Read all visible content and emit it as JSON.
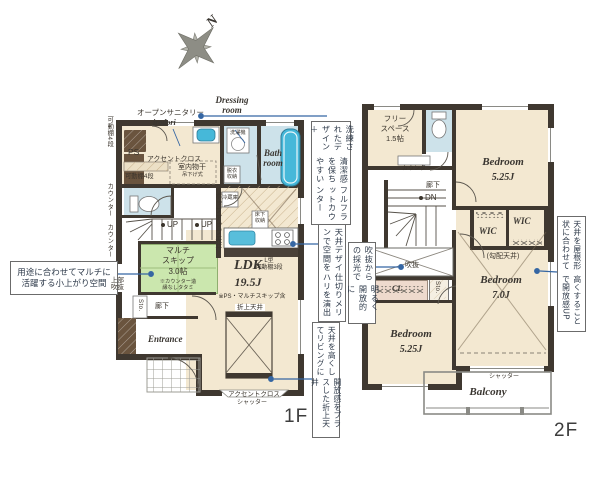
{
  "compass": {
    "north": "N"
  },
  "annotations": {
    "multi_skip": {
      "line1": "用途に合わせてマルチに",
      "line2": "活躍する小上がり空間"
    },
    "counter": {
      "col1": "洗練されたデザイン＋",
      "col2": "清潔感を保ちやすい",
      "col3": "フルフラットカウンター"
    },
    "ceiling_design": {
      "col1": "天井デザインで空間を",
      "col2": "仕切りメリハリを演出"
    },
    "folded_ceiling": {
      "col1": "天井を高くしてリビングに",
      "col2": "開放感をプラスした折上天井"
    },
    "void_light": {
      "col1": "吹抜からの採光で",
      "col2": "明るく開放的に"
    },
    "roof_ceiling": {
      "col1": "天井を屋根形状に合わせて",
      "col2": "高くすることで開放感UP"
    }
  },
  "floor1": {
    "floor_label": "1F",
    "open_sanitary": "オープンサニタリー",
    "irodori": "irodori",
    "dressing_room": "Dressing room",
    "bath_room": "Bath room",
    "ps": "PS",
    "accent_cloth_top": "アクセントクロス",
    "shelf4_side": "可動棚4段",
    "shelf4": "可動棚4段",
    "indoor_drying": "室内物干",
    "indoor_drying_sub": "吊下げ式",
    "washer": "洗濯機",
    "dressing_storage": "脱衣収納",
    "counter_side1": "カウンター",
    "counter_side2": "カウンター",
    "up1": "UP",
    "up2": "UP",
    "fridge": "冷蔵庫",
    "underfloor": "床下収納",
    "popup_ceiling": "ポップアップ天井",
    "l_shelf1": "L型",
    "l_shelf2": "可動棚3段",
    "multi1": "マルチ",
    "multi2": "スキップ",
    "multi3": "3.0帖",
    "multi_sub1": "※カウンター造",
    "multi_sub2": "縁なしタタミ",
    "upper_void": "上部吹抜",
    "sto": "Sto.",
    "hallway": "廊下",
    "entrance": "Entrance",
    "ldk": "LDK",
    "ldk_size": "19.5J",
    "ldk_note": "※PS・マルチスキップ含",
    "folded_ceiling": "折上天井",
    "accent_cloth_bottom": "アクセントクロス",
    "shutter": "シャッター"
  },
  "floor2": {
    "floor_label": "2F",
    "free_space1": "フリー",
    "free_space2": "スペース",
    "free_space3": "1.5帖",
    "counter": "カウンター",
    "hallway": "廊下",
    "dn": "DN",
    "void": "吹抜",
    "cl": "CL",
    "sto": "Sto.",
    "bedroom_tr": "Bedroom",
    "bedroom_tr_size": "5.25J",
    "wic1": "WIC",
    "wic2": "WIC",
    "sloped_ceiling": "(勾配天井)",
    "bedroom_r": "Bedroom",
    "bedroom_r_size": "7.0J",
    "bedroom_bl": "Bedroom",
    "bedroom_bl_size": "5.25J",
    "shutter": "シャッター",
    "balcony": "Balcony"
  },
  "colors": {
    "wall": "#3f3830",
    "closet_brown": "#6a543e",
    "floor_beige": "#f3e8d1",
    "wet_blue": "#cde2ea",
    "tub_blue": "#46b8d9",
    "tatami_green": "#cbe7ae",
    "cl_pink": "#eedacd",
    "leader_blue": "#3566a3"
  }
}
